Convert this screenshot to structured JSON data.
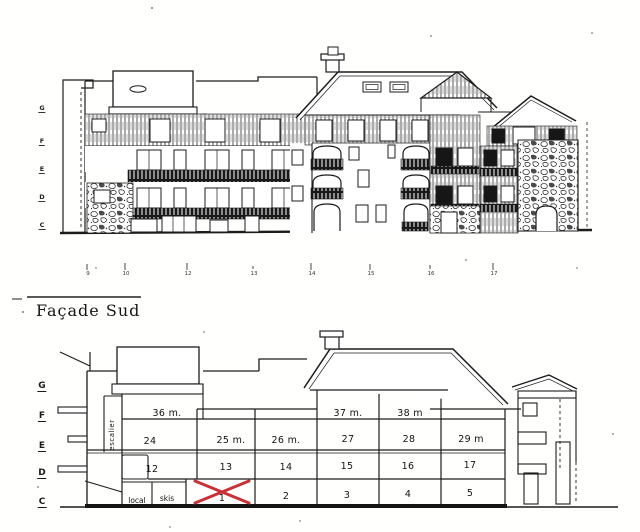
{
  "document": {
    "type": "architectural elevation sketch",
    "title": "Façade Sud"
  },
  "top_drawing": {
    "floor_letters": [
      "G",
      "F",
      "E",
      "D",
      "C"
    ]
  },
  "axis_ticks": [
    "9",
    "10",
    "12",
    "13",
    "14",
    "15",
    "16",
    "17"
  ],
  "bottom_drawing": {
    "floor_letters": [
      "G",
      "F",
      "E",
      "D",
      "C"
    ],
    "stair_label": "escalier",
    "floor_f_areas": [
      "36 m.",
      "37 m.",
      "38 m"
    ],
    "floor_e_units": [
      "24",
      "25 m.",
      "26 m.",
      "27",
      "28",
      "29 m"
    ],
    "floor_d_units": [
      "12",
      "13",
      "14",
      "15",
      "16",
      "17"
    ],
    "ground_floor_units": [
      "local",
      "skis",
      "1",
      "2",
      "3",
      "4",
      "5"
    ],
    "crossed_out_unit": "1",
    "cross_color": "#c53238"
  }
}
